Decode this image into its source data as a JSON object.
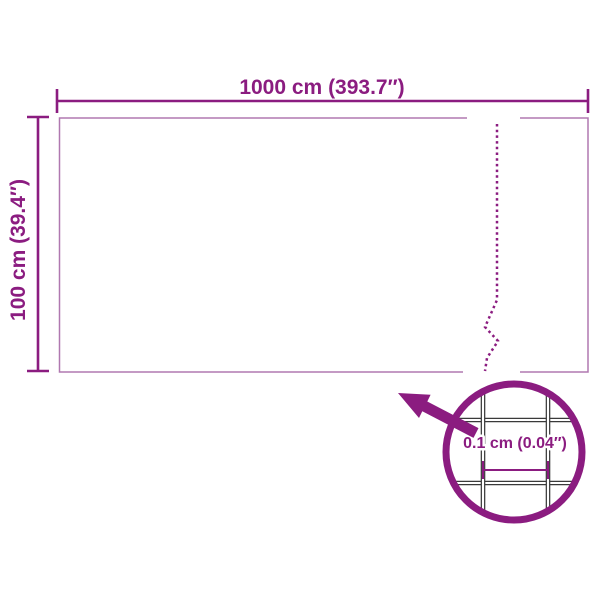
{
  "diagram": {
    "type": "product-dimension-diagram",
    "width_label": "1000 cm (393.7″)",
    "height_label": "100 cm (39.4″)",
    "mesh_detail_label": "0.1 cm (0.04″)"
  },
  "colors": {
    "accent_purple": "#8b1c80",
    "roll_outline": "#b078b0",
    "mesh_wire": "#3a3a3a",
    "background": "#ffffff"
  }
}
